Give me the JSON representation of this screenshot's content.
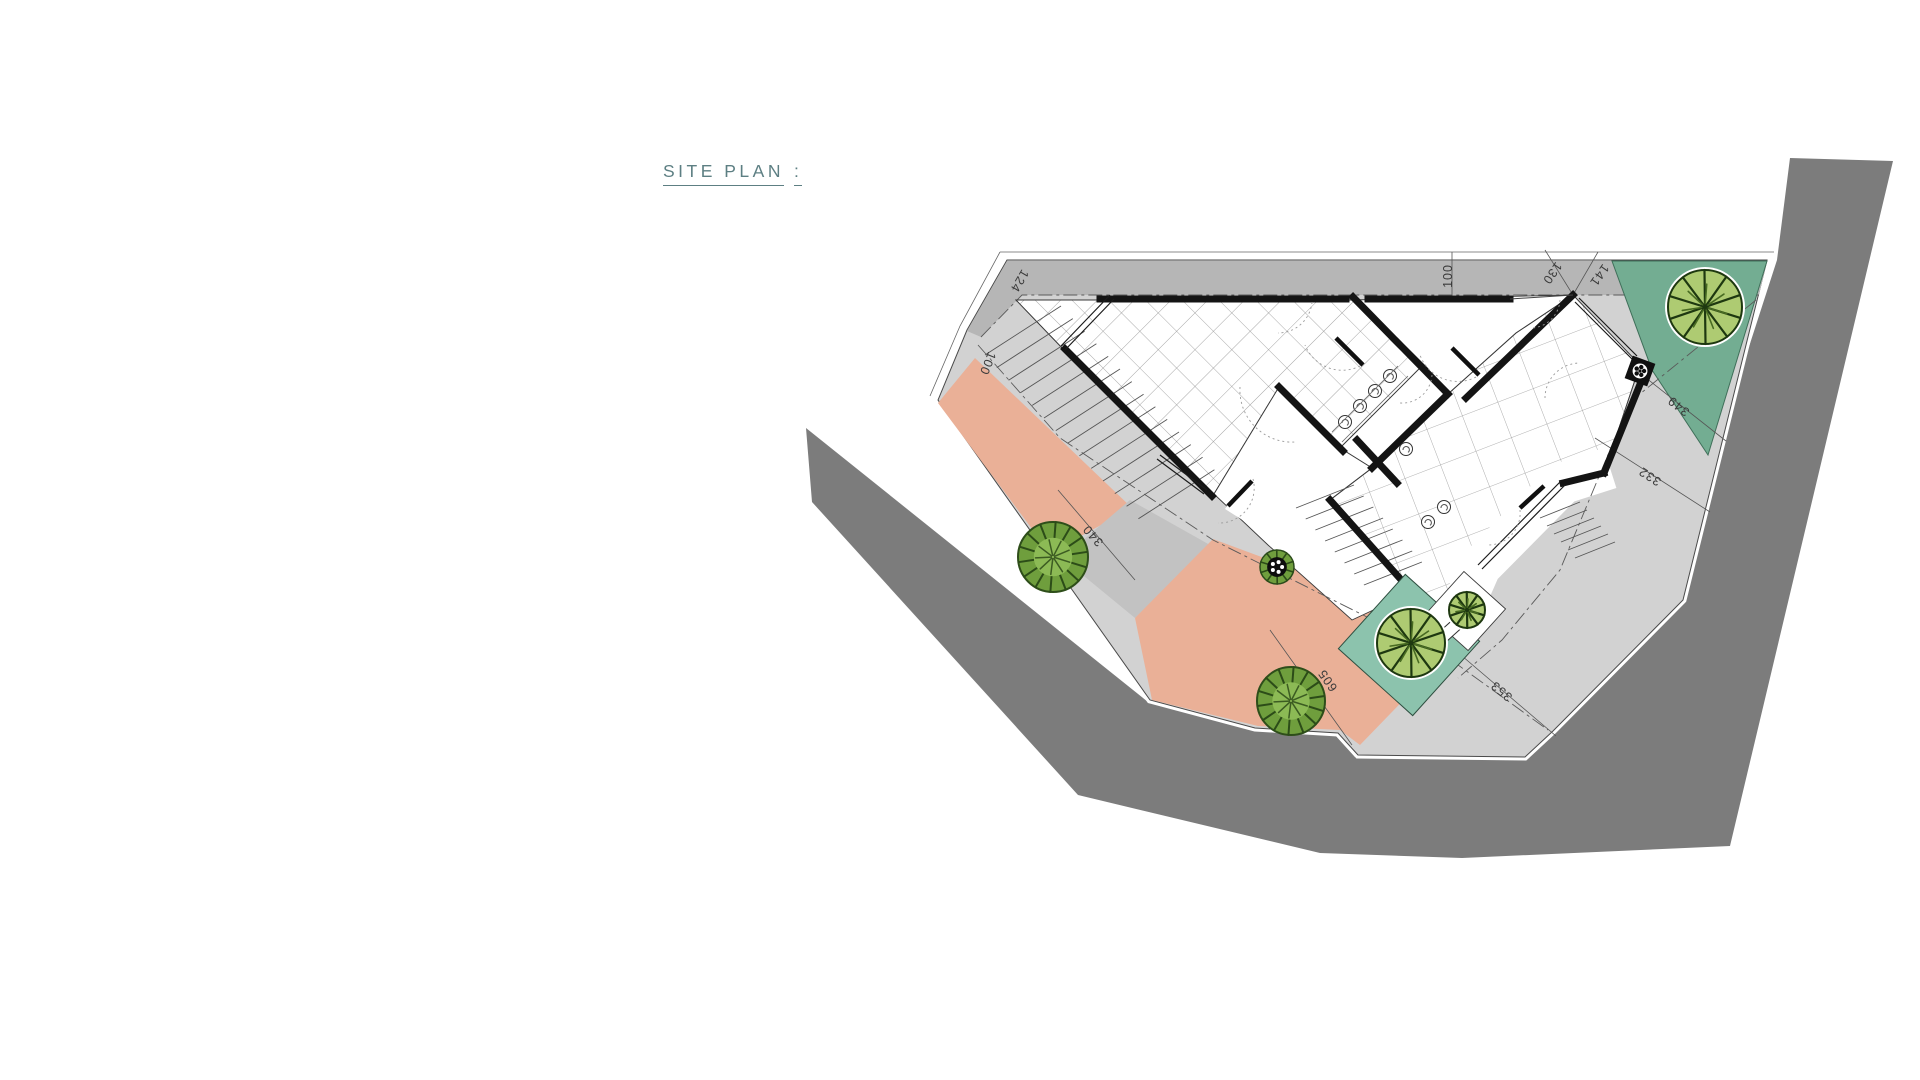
{
  "title": {
    "text": "SITE PLAN",
    "colon": ":"
  },
  "plan": {
    "colors": {
      "road": "#7c7c7c",
      "paving": "#d2d2d2",
      "setback_strip": "#b6b6b6",
      "terrace": "#eab097",
      "green_corner": "#73ad92",
      "green_planter_bed": "#8cc3ad",
      "wall": "#141414",
      "tile_line": "#909090",
      "dimension_text": "#3a3a3a",
      "title_text": "#5d7f83"
    },
    "dimension_labels": [
      {
        "text": "124",
        "x": 1016,
        "y": 279,
        "rotation": 120
      },
      {
        "text": "100",
        "x": 984,
        "y": 362,
        "rotation": 112
      },
      {
        "text": "100",
        "x": 1452,
        "y": 276,
        "rotation": -90
      },
      {
        "text": "130",
        "x": 1549,
        "y": 271,
        "rotation": 125
      },
      {
        "text": "141",
        "x": 1596,
        "y": 273,
        "rotation": 125
      },
      {
        "text": "349",
        "x": 1681,
        "y": 403,
        "rotation": 218
      },
      {
        "text": "332",
        "x": 1652,
        "y": 473,
        "rotation": 213
      },
      {
        "text": "340",
        "x": 1096,
        "y": 533,
        "rotation": 229
      },
      {
        "text": "605",
        "x": 1331,
        "y": 678,
        "rotation": 235
      },
      {
        "text": "353",
        "x": 1504,
        "y": 688,
        "rotation": 220
      }
    ],
    "trees": [
      {
        "type": "canopy",
        "x": 1705,
        "y": 307,
        "r": 37
      },
      {
        "type": "canopy",
        "x": 1411,
        "y": 643,
        "r": 34
      },
      {
        "type": "canopy",
        "x": 1467,
        "y": 610,
        "r": 18
      },
      {
        "type": "bushy",
        "x": 1053,
        "y": 557,
        "r": 35
      },
      {
        "type": "bushy",
        "x": 1291,
        "y": 701,
        "r": 34
      },
      {
        "type": "ring",
        "x": 1277,
        "y": 567,
        "r": 17
      },
      {
        "type": "planter",
        "x": 1640,
        "y": 371,
        "r": 12
      }
    ]
  }
}
